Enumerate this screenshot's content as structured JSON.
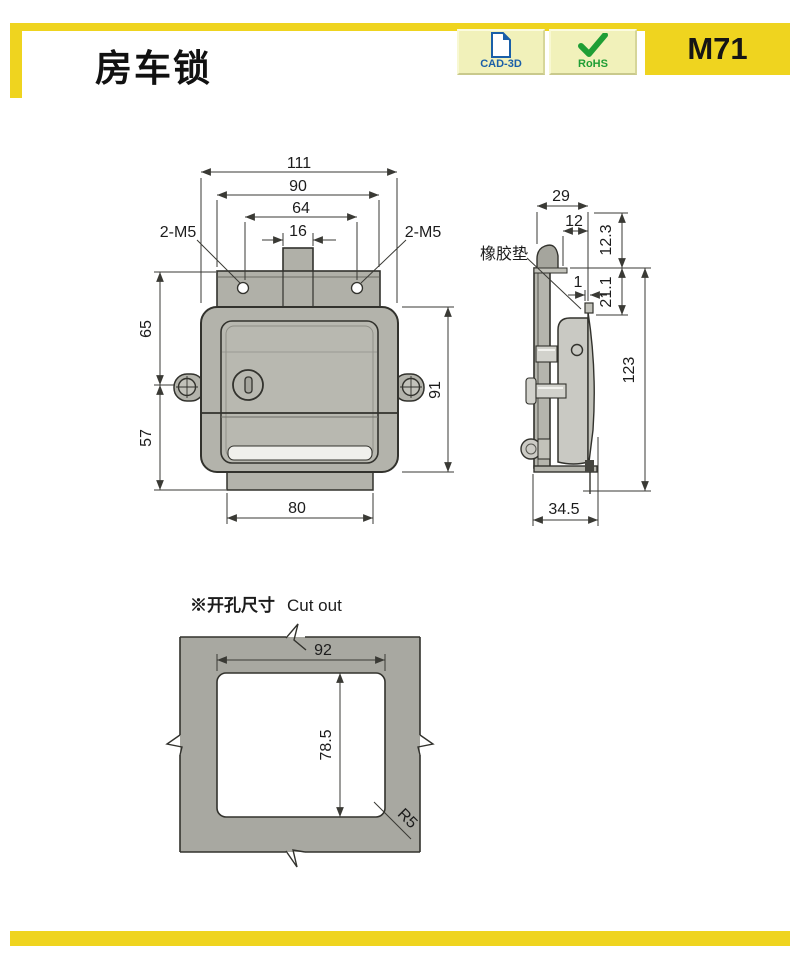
{
  "header": {
    "title": "房车锁",
    "model": "M71",
    "badge_cad": "CAD-3D",
    "badge_rohs": "RoHS"
  },
  "front_view": {
    "dim_width_overall": "111",
    "dim_plate_width": "90",
    "dim_hole_spacing": "64",
    "dim_tab_width": "16",
    "screw_left": "2-M5",
    "screw_right": "2-M5",
    "dim_upper_height": "65",
    "dim_lower_height": "57",
    "dim_body_height": "91",
    "dim_bottom_width": "80"
  },
  "side_view": {
    "dim_depth": "29",
    "dim_offset": "12",
    "dim_top_height": "12.3",
    "rubber_pad_label": "橡胶垫",
    "dim_gap": "1",
    "dim_mid_height": "21.1",
    "dim_total_height": "123",
    "dim_total_depth": "34.5"
  },
  "cutout_view": {
    "title_zh": "※开孔尺寸",
    "title_en": "Cut out",
    "dim_width": "92",
    "dim_height": "78.5",
    "dim_radius": "R5"
  },
  "colors": {
    "accent_yellow": "#efd41f",
    "badge_bg": "#f1f1ba",
    "cad_blue": "#1a5fa8",
    "rohs_green": "#1f9e35",
    "body_gray": "#b3b3ab",
    "panel_gray": "#a8a8a1"
  }
}
